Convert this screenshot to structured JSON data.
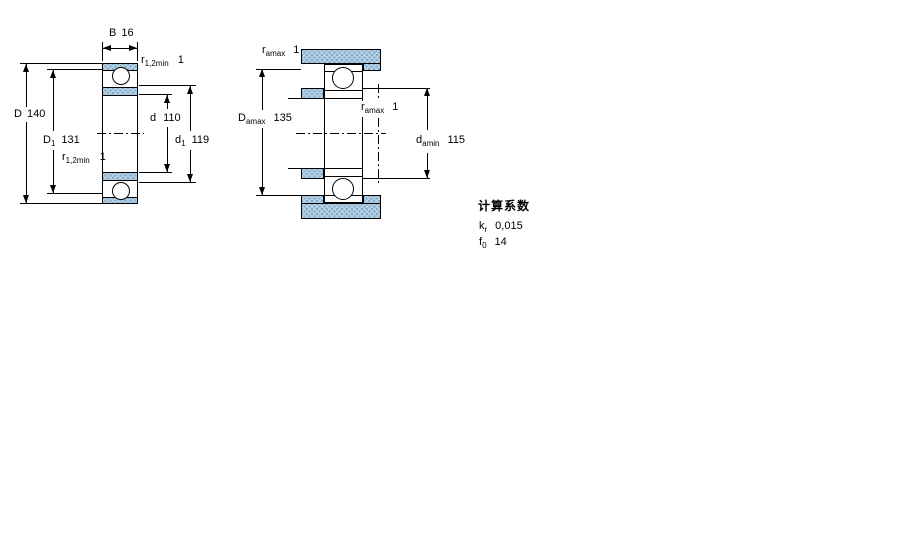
{
  "drawing": {
    "left_section": {
      "B": {
        "symbol": "B",
        "value": "16"
      },
      "r_top": {
        "symbol": "r",
        "sub": "1,2min",
        "value": "1"
      },
      "D": {
        "symbol": "D",
        "value": "140"
      },
      "D1": {
        "symbol": "D",
        "sub": "1",
        "value": "131"
      },
      "r_mid": {
        "symbol": "r",
        "sub": "1,2min",
        "value": "1"
      },
      "d": {
        "symbol": "d",
        "value": "110"
      },
      "d1": {
        "symbol": "d",
        "sub": "1",
        "value": "119"
      }
    },
    "right_section": {
      "ra_top": {
        "symbol": "r",
        "sub": "amax",
        "value": "1"
      },
      "Da": {
        "symbol": "D",
        "sub": "amax",
        "value": "135"
      },
      "ra_mid": {
        "symbol": "r",
        "sub": "amax",
        "value": "1"
      },
      "da": {
        "symbol": "d",
        "sub": "amin",
        "value": "115"
      }
    },
    "calculation_factors": {
      "title": "计算系数",
      "kr": {
        "symbol": "k",
        "sub": "r",
        "value": "0,015"
      },
      "f0": {
        "symbol": "f",
        "sub": "0",
        "value": "14"
      }
    },
    "colors": {
      "hatch_fill": "#b5d0e4",
      "hatch_dot": "#7fa7c4",
      "line": "#000000",
      "background": "#ffffff"
    }
  }
}
